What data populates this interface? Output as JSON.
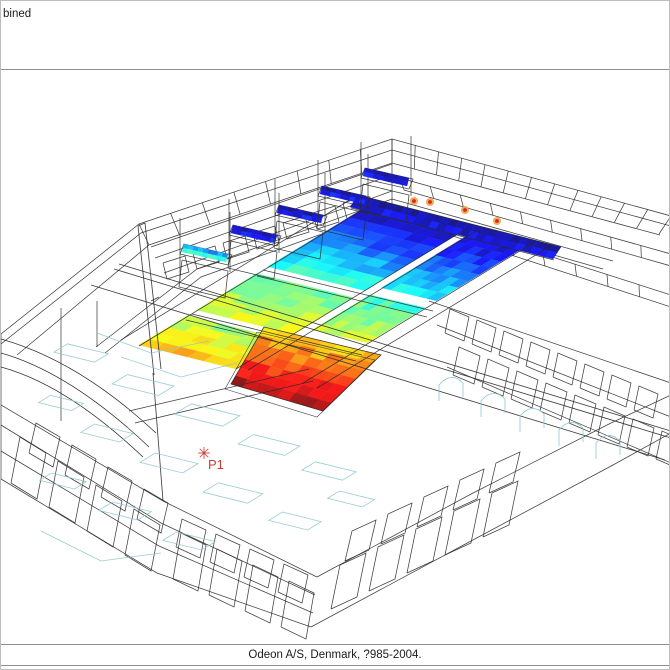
{
  "header": {
    "title": "bined"
  },
  "footer": {
    "copyright": "Odeon A/S, Denmark, ?985-2004."
  },
  "scene": {
    "background": "#ffffff",
    "wire_color": "#2b2b2b",
    "layer_color": "#8ec7cd",
    "divider_color": "#8f8f8f",
    "colormap": "jet",
    "source_marker": {
      "label": "P1",
      "color": "#cf3a30",
      "x": 203,
      "y": 452
    },
    "hot_dots": [
      [
        413,
        200
      ],
      [
        429,
        201
      ],
      [
        464,
        209
      ],
      [
        496,
        220
      ]
    ],
    "strips": [
      {
        "origin": [
          368,
          204
        ],
        "w": [
          97,
          24
        ],
        "l": [
          -230,
          140
        ],
        "segments": [
          {
            "a": 0.0,
            "b": 0.44,
            "v0": 0.03,
            "v1": 0.42
          },
          {
            "a": 0.49,
            "b": 0.75,
            "v0": 0.45,
            "v1": 0.62
          },
          {
            "a": 0.79,
            "b": 1.0,
            "v0": 0.52,
            "v1": 0.72
          }
        ]
      },
      {
        "origin": [
          477,
          228
        ],
        "w": [
          55,
          13
        ],
        "l": [
          -230,
          140
        ],
        "segments": [
          {
            "a": 0.0,
            "b": 0.42,
            "v0": 0.02,
            "v1": 0.38
          },
          {
            "a": 0.47,
            "b": 0.72,
            "v0": 0.42,
            "v1": 0.58
          }
        ]
      }
    ],
    "hot_block": {
      "corners": [
        [
          263,
          326
        ],
        [
          380,
          354
        ],
        [
          322,
          410
        ],
        [
          230,
          383
        ]
      ],
      "v0": 0.66,
      "v1": 0.97
    },
    "back_band": {
      "corners": [
        [
          357,
          194
        ],
        [
          560,
          246
        ],
        [
          552,
          258
        ],
        [
          349,
          206
        ]
      ],
      "v0": 0.0,
      "v1": 0.12
    },
    "balcony_strips": [
      {
        "x": 181,
        "y": 251,
        "v0": 0.2,
        "v1": 0.5
      },
      {
        "x": 230,
        "y": 232,
        "v0": 0.0,
        "v1": 0.15
      },
      {
        "x": 276,
        "y": 212,
        "v0": 0.0,
        "v1": 0.15
      },
      {
        "x": 319,
        "y": 193,
        "v0": 0.0,
        "v1": 0.15
      },
      {
        "x": 362,
        "y": 175,
        "v0": 0.0,
        "v1": 0.15
      }
    ],
    "cyan_shapes": [
      [
        80,
        352,
        42,
        16
      ],
      [
        142,
        384,
        48,
        18
      ],
      [
        206,
        414,
        50,
        20
      ],
      [
        268,
        444,
        48,
        18
      ],
      [
        328,
        470,
        42,
        16
      ],
      [
        106,
        432,
        40,
        16
      ],
      [
        168,
        462,
        44,
        18
      ],
      [
        232,
        492,
        46,
        18
      ],
      [
        294,
        520,
        40,
        16
      ],
      [
        62,
        480,
        36,
        14
      ],
      [
        124,
        510,
        40,
        16
      ],
      [
        188,
        540,
        40,
        16
      ],
      [
        60,
        402,
        34,
        14
      ],
      [
        350,
        498,
        36,
        14
      ]
    ],
    "arch_windows": [
      [
        450,
        386
      ],
      [
        492,
        402
      ],
      [
        531,
        417
      ],
      [
        570,
        431
      ],
      [
        607,
        444
      ]
    ]
  }
}
